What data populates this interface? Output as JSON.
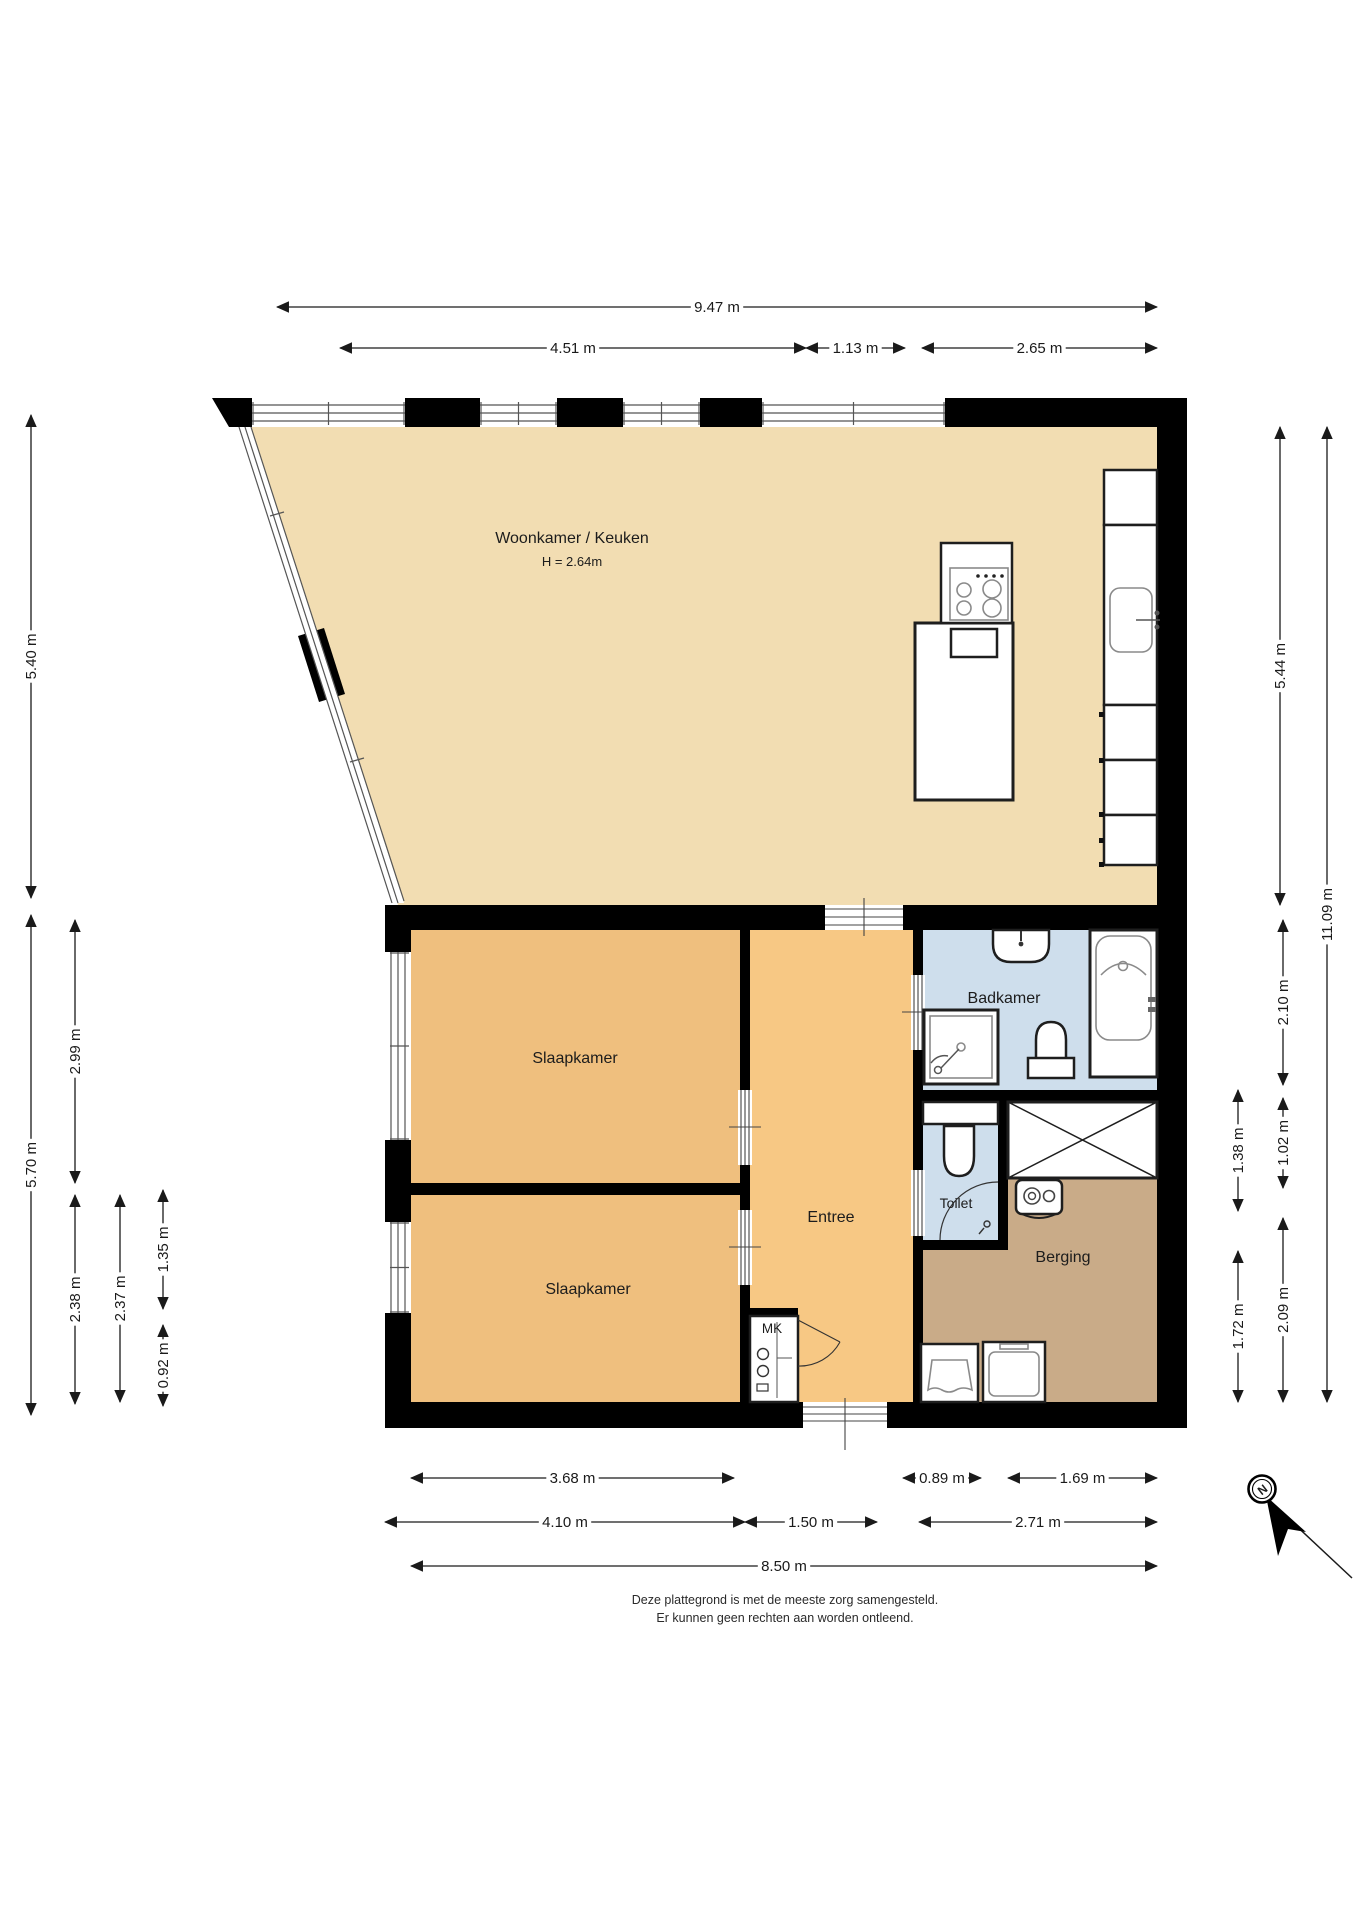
{
  "plan": {
    "rooms": {
      "living": {
        "label": "Woonkamer / Keuken",
        "height_label": "H = 2.64m"
      },
      "bedroom1": {
        "label": "Slaapkamer"
      },
      "bedroom2": {
        "label": "Slaapkamer"
      },
      "hallway": {
        "label": "Entree"
      },
      "bathroom": {
        "label": "Badkamer"
      },
      "toilet": {
        "label": "Toilet"
      },
      "storage": {
        "label": "Berging"
      },
      "meter_cupboard": {
        "label": "MK"
      }
    },
    "dimensions": {
      "top": [
        {
          "id": "t1",
          "label": "9.47 m"
        },
        {
          "id": "t2",
          "label": "4.51 m"
        },
        {
          "id": "t3",
          "label": "1.13 m"
        },
        {
          "id": "t4",
          "label": "2.65 m"
        }
      ],
      "bottom": [
        {
          "id": "b1",
          "label": "3.68 m"
        },
        {
          "id": "b2",
          "label": "0.89 m"
        },
        {
          "id": "b3",
          "label": "1.69 m"
        },
        {
          "id": "b4",
          "label": "4.10 m"
        },
        {
          "id": "b5",
          "label": "1.50 m"
        },
        {
          "id": "b6",
          "label": "2.71 m"
        },
        {
          "id": "b7",
          "label": "8.50 m"
        }
      ],
      "left": [
        {
          "id": "l1",
          "label": "5.40 m"
        },
        {
          "id": "l2",
          "label": "5.70 m"
        },
        {
          "id": "l3",
          "label": "2.99 m"
        },
        {
          "id": "l4",
          "label": "2.38 m"
        },
        {
          "id": "l5",
          "label": "2.37 m"
        },
        {
          "id": "l6",
          "label": "1.35 m"
        },
        {
          "id": "l7",
          "label": "0.92 m"
        }
      ],
      "right": [
        {
          "id": "r1",
          "label": "5.44 m"
        },
        {
          "id": "r2",
          "label": "11.09 m"
        },
        {
          "id": "r3",
          "label": "2.10 m"
        },
        {
          "id": "r4",
          "label": "1.38 m"
        },
        {
          "id": "r5",
          "label": "1.02 m"
        },
        {
          "id": "r6",
          "label": "1.72 m"
        },
        {
          "id": "r7",
          "label": "2.09 m"
        }
      ]
    },
    "compass": {
      "north_label": "N"
    },
    "footer": {
      "line1": "Deze plattegrond is met de meeste zorg samengesteld.",
      "line2": "Er kunnen geen rechten aan worden ontleend."
    },
    "palette": {
      "wall": "#000000",
      "living": "#F2DDB2",
      "bedroom": "#EFBF7E",
      "hallway": "#F7C884",
      "bathroom": "#CEDEEC",
      "storage": "#C9AB88"
    }
  }
}
